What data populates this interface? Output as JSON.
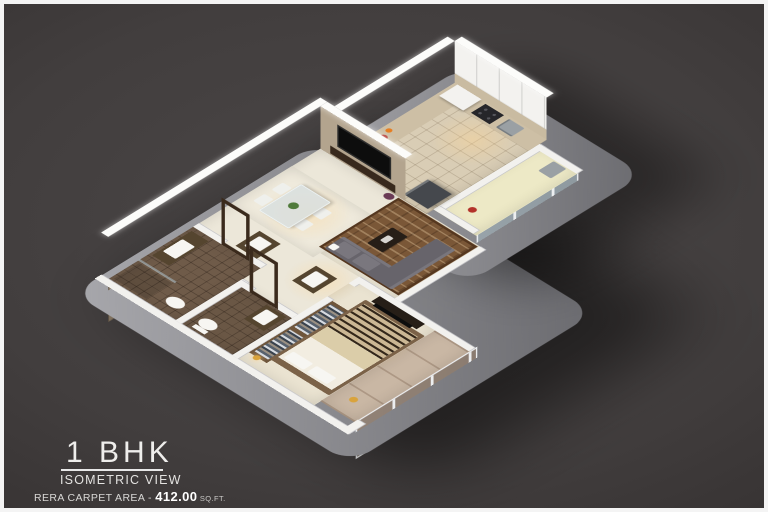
{
  "title_block": {
    "title": "1 BHK",
    "subtitle": "ISOMETRIC VIEW",
    "area_label": "RERA CARPET AREA - ",
    "area_value": "412.00",
    "area_unit": " SQ.FT."
  },
  "scene": {
    "background_center": "#4b4747",
    "background_edge": "#332f2f",
    "frame_border": "#f4f4f4",
    "platform_color": "#8f8f95",
    "wall_color": "#f3f2ef",
    "wall_top_color": "#fcfcfa"
  },
  "rooms": {
    "bathroom": {
      "floor": "#6f5b49"
    },
    "toilet": {
      "floor": "#6a5745"
    },
    "main": {
      "floor": "#ece7d9"
    },
    "dining": {
      "floor": "#efeadc"
    },
    "living": {
      "floor": "#ebe5d4"
    },
    "kitchen": {
      "floor": "#d9cdb5"
    },
    "utility": {
      "floor": "#ede9c6"
    },
    "bedroom": {
      "floor": "#eae3d1"
    },
    "balcony": {
      "floor": "#c9b7a4"
    }
  },
  "furniture": {
    "sofa": "#67646b",
    "sofa_cushion": "#7a777e",
    "rug": "#7a5737",
    "coffee_table": "#261e17",
    "tv_panel_wall": "#b3a48e",
    "tv_screen": "#0d0d0d",
    "tv_console": "#38291d",
    "bed_mattress": "#f2ede1",
    "bed_throw": "#dbcda9",
    "bed_frame": "#7b6248",
    "wardrobe": "#6f563c",
    "fridge": "#45484d",
    "counter": "#cdbfa5",
    "stove": "#26262a",
    "sink": "#9aa0a4",
    "basin_counter": "#55452f",
    "basin_white": "#f7f6f2",
    "door_wood": "#3a2a1c",
    "dining_wall": "#b3b5bb",
    "bath_tile_wall": "#8a7a66",
    "table_glass": "rgba(215,222,224,0.8)",
    "chair_white": "#eff0ec",
    "plant_green": "#4f7a3a",
    "glass_balcony": "rgba(155,125,98,0.5)",
    "glass_partition": "rgba(170,195,205,0.45)",
    "accent_red": "#b3322a",
    "accent_amber": "#d9a33c"
  }
}
